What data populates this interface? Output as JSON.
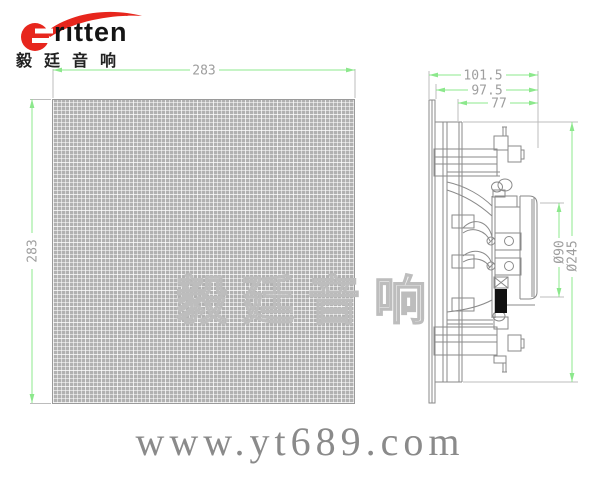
{
  "brand": {
    "logo_text": "ritten",
    "logo_cn": "毅廷音响"
  },
  "front_view": {
    "width_label": "283",
    "height_label": "283"
  },
  "side_view": {
    "depth_total_label": "101.5",
    "depth_mid_label": "97.5",
    "depth_inner_label": "77",
    "driver_diameter_label": "Ø90",
    "overall_diameter_label": "Ø245"
  },
  "watermark_text": "毅廷音响",
  "website": "www.yt689.com",
  "colors": {
    "dimension_green": "#8ce88c",
    "drawing_gray": "#8a8a8a",
    "brand_red": "#e7261d",
    "grille_gray": "#b1b1b1"
  }
}
